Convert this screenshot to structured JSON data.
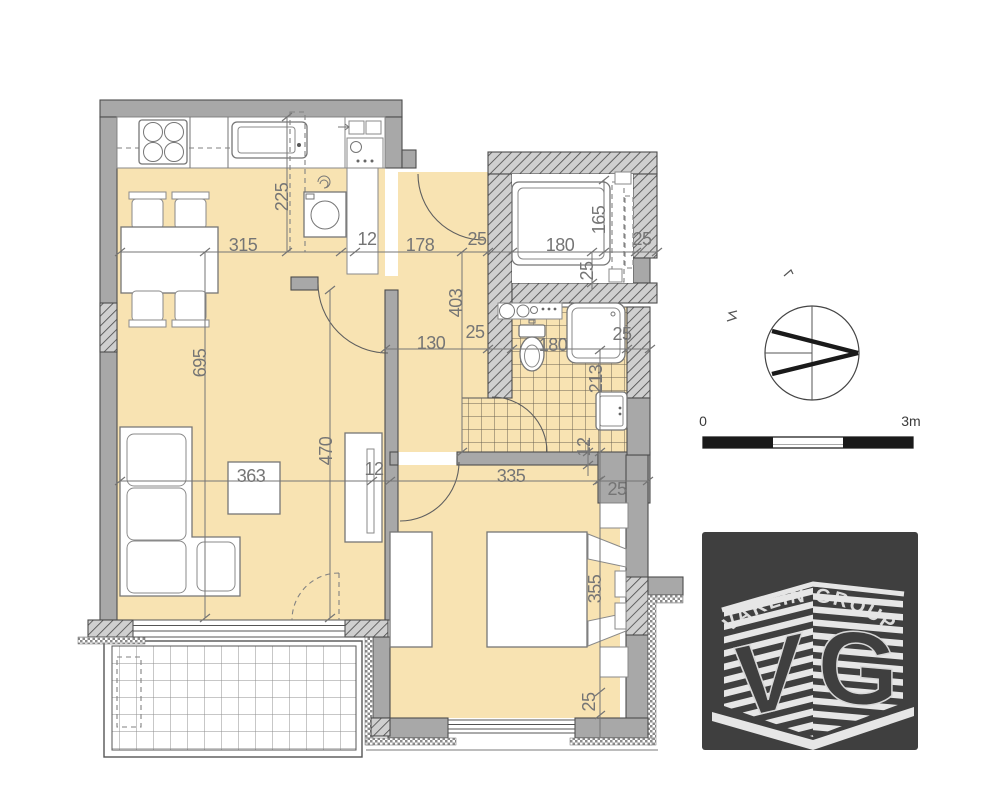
{
  "plan": {
    "dimensions": [
      {
        "text": "225",
        "x": 282,
        "y": 197,
        "rot": -90
      },
      {
        "text": "315",
        "x": 243,
        "y": 245,
        "rot": 0
      },
      {
        "text": "12",
        "x": 367,
        "y": 239,
        "rot": 0
      },
      {
        "text": "178",
        "x": 420,
        "y": 245,
        "rot": 0
      },
      {
        "text": "25",
        "x": 477,
        "y": 239,
        "rot": 0
      },
      {
        "text": "180",
        "x": 560,
        "y": 245,
        "rot": 0
      },
      {
        "text": "165",
        "x": 599,
        "y": 220,
        "rot": -90
      },
      {
        "text": "25",
        "x": 642,
        "y": 239,
        "rot": 0
      },
      {
        "text": "25",
        "x": 587,
        "y": 271,
        "rot": -90
      },
      {
        "text": "695",
        "x": 200,
        "y": 363,
        "rot": -90
      },
      {
        "text": "403",
        "x": 456,
        "y": 303,
        "rot": -90
      },
      {
        "text": "130",
        "x": 431,
        "y": 343,
        "rot": 0
      },
      {
        "text": "25",
        "x": 475,
        "y": 332,
        "rot": 0
      },
      {
        "text": "180",
        "x": 553,
        "y": 345,
        "rot": 0
      },
      {
        "text": "25",
        "x": 622,
        "y": 334,
        "rot": 0
      },
      {
        "text": "213",
        "x": 596,
        "y": 379,
        "rot": -90
      },
      {
        "text": "12",
        "x": 584,
        "y": 447,
        "rot": -90
      },
      {
        "text": "363",
        "x": 251,
        "y": 476,
        "rot": 0
      },
      {
        "text": "470",
        "x": 326,
        "y": 451,
        "rot": -90
      },
      {
        "text": "12",
        "x": 374,
        "y": 469,
        "rot": 0
      },
      {
        "text": "335",
        "x": 511,
        "y": 476,
        "rot": 0
      },
      {
        "text": "25",
        "x": 617,
        "y": 489,
        "rot": 0
      },
      {
        "text": "355",
        "x": 595,
        "y": 589,
        "rot": -90
      },
      {
        "text": "25",
        "x": 589,
        "y": 702,
        "rot": -90
      }
    ]
  },
  "scale_bar": {
    "min_label": "0",
    "max_label": "3m"
  },
  "logo": {
    "brand": "VAKLIN GROUP",
    "monogram_v": "V",
    "monogram_g": "G"
  },
  "colors": {
    "floor": "#f8e3b2",
    "wall": "#a8a8a8",
    "hatch_bg": "#cfcfcf",
    "outline": "#4d4d4d",
    "dimension": "#757575",
    "tile_line": "#6b6353",
    "logo_bg": "#3f3f3f",
    "scale_black": "#1a1a1a"
  }
}
